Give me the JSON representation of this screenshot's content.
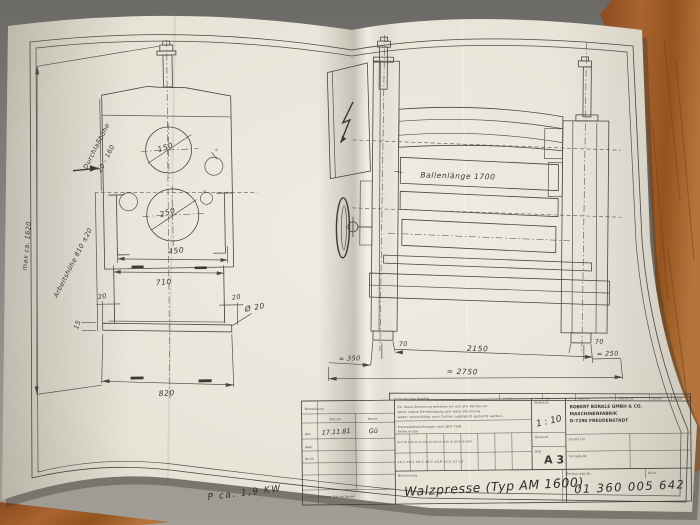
{
  "colors": {
    "paper": "#e9e5da",
    "ink": "#4a463f",
    "handwriting": "#312e28",
    "carpet": "#8b8984",
    "wood": "#9c5a28"
  },
  "left_view": {
    "dim_max_height": "max ca. 1620",
    "label_pass_height": "Durchlaßhöhe",
    "value_pass_height": "20 - 160",
    "label_work_height": "Arbeitshöhe 810 ±20",
    "dia_top_roll": "150",
    "dia_bottom_roll": "250",
    "dia_small": "Ø",
    "dim_450": "450",
    "dim_710": "710",
    "dim_20_left": "20",
    "dim_20_right": "20",
    "dim_15": "15",
    "dia_bolt": "Ø 20",
    "dim_820": "820"
  },
  "right_view": {
    "label_ballenlaenge": "Ballenlänge 1700",
    "dim_70_left": "70",
    "dim_70_right": "70",
    "dim_2150": "2150",
    "dim_350": "≈ 350",
    "dim_250": "≈ 250",
    "dim_2750": "≈ 2750"
  },
  "annotations": {
    "power": "P  ca.  1,9 KW"
  },
  "title_block": {
    "header_cells": [
      "Zeichnungs- bzw. Modell-Nr.",
      "Gestell",
      "DIN",
      "Werk-Nr.",
      "Gewicht kg",
      "Fabrikat",
      "Anzahl"
    ],
    "revision": {
      "col_datum": "Datum",
      "col_name": "Name",
      "row_bem": "Bemerkung",
      "row_gez": "gez.",
      "row_gepr": "gepr.",
      "row_norm": "Norm",
      "date": "17.11.81",
      "sign": "Gü",
      "bottom": "Zust.   Änderung   Datum   Name"
    },
    "copyright_l1": "Für diese Zeichnung behalten wir uns alle Rechte vor.",
    "copyright_l2": "Ohne unsere Genehmigung darf diese Zeichnung",
    "copyright_l3": "weder vervielfältigt noch Dritten zugänglich gemacht werden.",
    "tolerance_title": "Freimaßabweichungen nach DIN 7168",
    "tolerance_sub": "Reihe mittel",
    "tol_head_row": "bis 6   ab 6   ab 30   ab 120   ab 400   ab 1000  ab 2000  ab 4000",
    "tol_val_row": "±0,1   ±0,2   ±0,3   ±0,5    ±0,8    ±1,2    ±2     ±3",
    "scale_label": "Maßstab",
    "scale_value": "1 : 10",
    "weight_label": "Gewicht",
    "format_label": "DIN",
    "format_value": "A 3",
    "company_l1": "ROBERT BÜRKLE GMBH & CO.",
    "company_l2": "MASCHINENFABRIK",
    "company_l3": "D-7290 FREUDENSTADT",
    "field_ersatz": "Ersatz für",
    "field_vorlage": "Vorlage-Nr.",
    "title_label": "Benennung",
    "title_value": "Walzpresse (Typ AM 1600)",
    "number_label": "Zeichnungs-Nr.",
    "sheet_label": "Blatt",
    "number_value": "01 360 005 642"
  }
}
